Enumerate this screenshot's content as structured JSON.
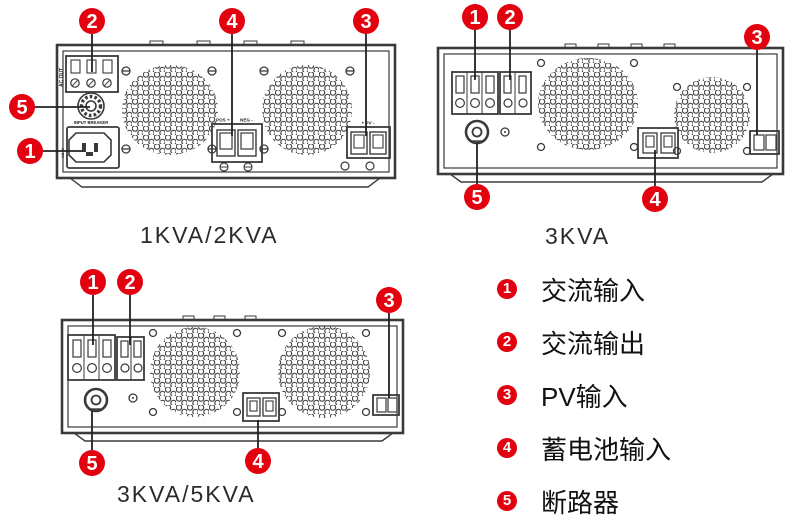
{
  "colors": {
    "callout_red": "#e3000f",
    "line": "#3a3a3a",
    "text": "#2b2b2b"
  },
  "devices": [
    {
      "caption": "1KVA/2KVA",
      "callouts": [
        "2",
        "4",
        "3",
        "5",
        "1"
      ],
      "labels": {
        "ac_out": "AC OUT",
        "input_breaker": "INPUT BREAKER",
        "ac_in": "AC IN",
        "bat_pos": "POS +",
        "bat_neg": "NEG -",
        "pv": "+ PV -"
      }
    },
    {
      "caption": "3KVA",
      "callouts": [
        "1",
        "2",
        "3",
        "5",
        "4"
      ]
    },
    {
      "caption": "3KVA/5KVA",
      "callouts": [
        "1",
        "2",
        "3",
        "5",
        "4"
      ]
    }
  ],
  "legend": {
    "items": [
      {
        "num": "1",
        "label": "交流输入"
      },
      {
        "num": "2",
        "label": "交流输出"
      },
      {
        "num": "3",
        "label": "PV输入"
      },
      {
        "num": "4",
        "label": "蓄电池输入"
      },
      {
        "num": "5",
        "label": "断路器"
      }
    ]
  }
}
